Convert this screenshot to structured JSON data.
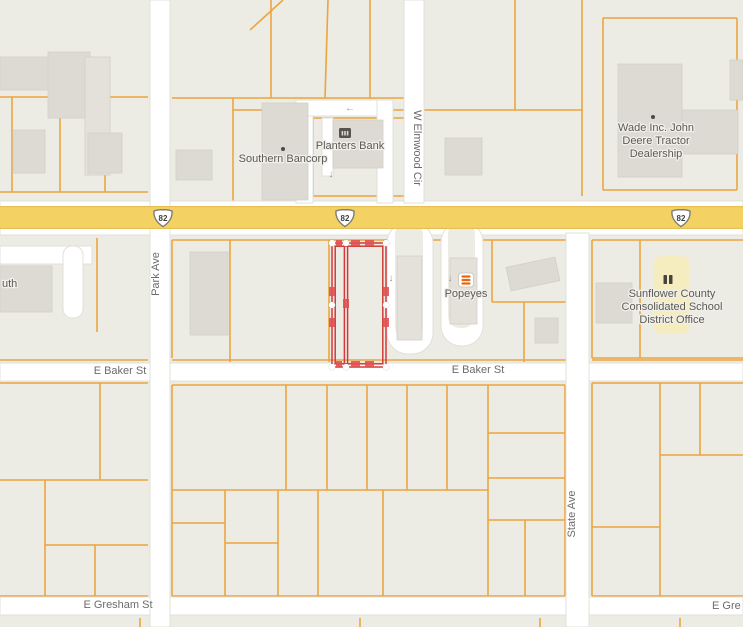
{
  "map": {
    "width": 743,
    "height": 627,
    "colors": {
      "background": "#ecebe4",
      "road": "#ffffff",
      "road_casing": "#e2e0d9",
      "parcel_line": "#eca53f",
      "building": "#dcdad2",
      "building_light": "#e3e1da",
      "building_border": "#d1cfc7",
      "highway": "#f3d263",
      "highway_edge": "#e6c055",
      "highlight_red": "#d43a3a",
      "highlight_tick": "#e05252",
      "school_area": "#f5edc0",
      "street_label": "#6b6b6b",
      "poi_label": "#5c5a54",
      "icon_dark": "#4b4a45",
      "popeyes_orange": "#e8680f",
      "arrow_gray": "#97958e"
    },
    "roads": [
      {
        "name": "us-82-road",
        "x": 0,
        "y": 201,
        "w": 743,
        "h": 34
      },
      {
        "name": "e-baker-st-road",
        "x": 0,
        "y": 363,
        "w": 743,
        "h": 18
      },
      {
        "name": "e-gresham-st-road",
        "x": 0,
        "y": 597,
        "w": 743,
        "h": 18
      },
      {
        "name": "park-ave-road",
        "x": 150,
        "y": 0,
        "w": 20,
        "h": 627
      },
      {
        "name": "w-elmwood-cir-road",
        "x": 404,
        "y": 0,
        "w": 20,
        "h": 203
      },
      {
        "name": "state-ave-road",
        "x": 566,
        "y": 233,
        "w": 23,
        "h": 394
      },
      {
        "name": "driveway",
        "x": 296,
        "y": 100,
        "w": 17,
        "h": 103
      },
      {
        "name": "driveway",
        "x": 296,
        "y": 100,
        "w": 97,
        "h": 16
      },
      {
        "name": "driveway",
        "x": 377,
        "y": 100,
        "w": 16,
        "h": 103
      },
      {
        "name": "driveway",
        "x": 322,
        "y": 118,
        "w": 11,
        "h": 58
      },
      {
        "name": "driveway-loop",
        "x": 387,
        "y": 222,
        "w": 46,
        "h": 132,
        "rx": 21
      },
      {
        "name": "driveway-loop",
        "x": 441,
        "y": 222,
        "w": 42,
        "h": 124,
        "rx": 20
      },
      {
        "name": "street-stub",
        "x": 0,
        "y": 246,
        "w": 92,
        "h": 18
      },
      {
        "name": "street-stub",
        "x": 63,
        "y": 246,
        "w": 20,
        "h": 72,
        "rx": 9
      }
    ],
    "road_islands": [
      {
        "x": 395,
        "y": 222,
        "w": 28,
        "h": 118,
        "rx": 13
      },
      {
        "x": 448,
        "y": 222,
        "w": 27,
        "h": 106,
        "rx": 12
      }
    ],
    "parcel_lines": [
      [
        0,
        97,
        148,
        97
      ],
      [
        12,
        97,
        12,
        192
      ],
      [
        60,
        97,
        60,
        192
      ],
      [
        105,
        97,
        105,
        192
      ],
      [
        0,
        192,
        148,
        192
      ],
      [
        172,
        98,
        404,
        98
      ],
      [
        233,
        98,
        233,
        201
      ],
      [
        271,
        0,
        271,
        98
      ],
      [
        250,
        30,
        283,
        0
      ],
      [
        328,
        0,
        325,
        98
      ],
      [
        370,
        0,
        370,
        98
      ],
      [
        233,
        110,
        404,
        110
      ],
      [
        313,
        110,
        313,
        196
      ],
      [
        313,
        118,
        404,
        118
      ],
      [
        313,
        196,
        404,
        196
      ],
      [
        582,
        0,
        582,
        196
      ],
      [
        424,
        110,
        582,
        110
      ],
      [
        515,
        0,
        515,
        110
      ],
      [
        603,
        18,
        737,
        18
      ],
      [
        603,
        18,
        603,
        190
      ],
      [
        737,
        18,
        737,
        190
      ],
      [
        603,
        190,
        737,
        190
      ],
      [
        592,
        240,
        743,
        240
      ],
      [
        592,
        240,
        592,
        358
      ],
      [
        640,
        240,
        640,
        358
      ],
      [
        592,
        358,
        743,
        358
      ],
      [
        172,
        240,
        566,
        240
      ],
      [
        172,
        240,
        172,
        358
      ],
      [
        230,
        240,
        230,
        362
      ],
      [
        329,
        240,
        329,
        362
      ],
      [
        430,
        240,
        430,
        292
      ],
      [
        492,
        240,
        492,
        302
      ],
      [
        492,
        302,
        566,
        302
      ],
      [
        524,
        302,
        524,
        362
      ],
      [
        0,
        360,
        148,
        360
      ],
      [
        172,
        360,
        566,
        360
      ],
      [
        592,
        360,
        743,
        360
      ],
      [
        97,
        238,
        97,
        332
      ],
      [
        0,
        383,
        148,
        383
      ],
      [
        100,
        383,
        100,
        480
      ],
      [
        0,
        480,
        148,
        480
      ],
      [
        45,
        480,
        45,
        597
      ],
      [
        45,
        545,
        148,
        545
      ],
      [
        95,
        545,
        95,
        597
      ],
      [
        0,
        596,
        148,
        596
      ],
      [
        172,
        385,
        565,
        385
      ],
      [
        172,
        385,
        172,
        596
      ],
      [
        565,
        385,
        565,
        596
      ],
      [
        172,
        596,
        565,
        596
      ],
      [
        172,
        490,
        488,
        490
      ],
      [
        286,
        385,
        286,
        490
      ],
      [
        327,
        385,
        327,
        490
      ],
      [
        367,
        385,
        367,
        490
      ],
      [
        407,
        385,
        407,
        490
      ],
      [
        447,
        385,
        447,
        490
      ],
      [
        488,
        385,
        488,
        596
      ],
      [
        488,
        433,
        565,
        433
      ],
      [
        488,
        478,
        565,
        478
      ],
      [
        488,
        520,
        565,
        520
      ],
      [
        525,
        520,
        525,
        596
      ],
      [
        172,
        523,
        225,
        523
      ],
      [
        225,
        490,
        225,
        596
      ],
      [
        225,
        543,
        278,
        543
      ],
      [
        278,
        490,
        278,
        596
      ],
      [
        318,
        490,
        318,
        596
      ],
      [
        383,
        490,
        383,
        596
      ],
      [
        592,
        383,
        743,
        383
      ],
      [
        592,
        383,
        592,
        596
      ],
      [
        660,
        383,
        660,
        596
      ],
      [
        660,
        455,
        743,
        455
      ],
      [
        592,
        527,
        660,
        527
      ],
      [
        700,
        383,
        700,
        455
      ],
      [
        592,
        596,
        743,
        596
      ],
      [
        140,
        618,
        140,
        627
      ],
      [
        360,
        618,
        360,
        627
      ],
      [
        540,
        618,
        540,
        627
      ],
      [
        680,
        618,
        680,
        627
      ]
    ],
    "buildings": [
      {
        "x": 0,
        "y": 57,
        "w": 88,
        "h": 33
      },
      {
        "x": 48,
        "y": 52,
        "w": 42,
        "h": 66
      },
      {
        "x": 85,
        "y": 57,
        "w": 25,
        "h": 118,
        "light": true
      },
      {
        "x": 13,
        "y": 130,
        "w": 32,
        "h": 43
      },
      {
        "x": 88,
        "y": 133,
        "w": 34,
        "h": 40
      },
      {
        "x": 176,
        "y": 150,
        "w": 36,
        "h": 30
      },
      {
        "x": 262,
        "y": 103,
        "w": 46,
        "h": 97
      },
      {
        "x": 333,
        "y": 120,
        "w": 50,
        "h": 48
      },
      {
        "x": 445,
        "y": 138,
        "w": 37,
        "h": 37
      },
      {
        "x": 618,
        "y": 64,
        "w": 64,
        "h": 113
      },
      {
        "x": 682,
        "y": 110,
        "w": 56,
        "h": 44
      },
      {
        "x": 730,
        "y": 60,
        "w": 13,
        "h": 40
      },
      {
        "x": 596,
        "y": 283,
        "w": 36,
        "h": 40
      },
      {
        "x": 190,
        "y": 252,
        "w": 38,
        "h": 83
      },
      {
        "x": 397,
        "y": 256,
        "w": 25,
        "h": 84,
        "light": true
      },
      {
        "x": 450,
        "y": 258,
        "w": 27,
        "h": 66,
        "light": true
      },
      {
        "x": 508,
        "y": 262,
        "w": 50,
        "h": 24,
        "rotate": -12
      },
      {
        "x": 535,
        "y": 318,
        "w": 23,
        "h": 25
      },
      {
        "x": 0,
        "y": 266,
        "w": 52,
        "h": 46
      }
    ],
    "school_area": {
      "x": 654,
      "y": 256,
      "w": 35,
      "h": 78
    },
    "highway": {
      "y": 206,
      "h": 23,
      "shield_label": "82",
      "shields": [
        {
          "x": 163,
          "y": 218
        },
        {
          "x": 345,
          "y": 218
        },
        {
          "x": 681,
          "y": 218
        }
      ]
    },
    "selected_parcel": {
      "x": 332,
      "y": 243,
      "w": 54,
      "h": 124,
      "divider_x": 346,
      "vertices": [
        [
          332,
          243
        ],
        [
          346,
          243
        ],
        [
          386,
          243
        ],
        [
          332,
          367
        ],
        [
          346,
          367
        ],
        [
          386,
          367
        ],
        [
          332,
          305
        ],
        [
          386,
          305
        ]
      ],
      "ticks": [
        [
          351,
          240,
          9,
          6
        ],
        [
          365,
          240,
          9,
          6
        ],
        [
          351,
          361,
          9,
          6
        ],
        [
          365,
          361,
          9,
          6
        ],
        [
          329,
          287,
          6,
          9
        ],
        [
          329,
          318,
          6,
          9
        ],
        [
          383,
          287,
          6,
          9
        ],
        [
          383,
          318,
          6,
          9
        ],
        [
          343,
          299,
          6,
          9
        ],
        [
          336,
          240,
          6,
          6
        ],
        [
          336,
          361,
          6,
          6
        ]
      ]
    },
    "arrows": [
      {
        "x": 331,
        "y": 177,
        "glyph": "↓"
      },
      {
        "x": 391,
        "y": 281,
        "glyph": "↓"
      },
      {
        "x": 450,
        "y": 281,
        "glyph": "↓"
      },
      {
        "x": 350,
        "y": 111,
        "glyph": "←"
      }
    ],
    "street_labels": [
      {
        "text": "Park Ave",
        "x": 159,
        "y": 274,
        "rotate": -90
      },
      {
        "text": "W Elmwood Cir",
        "x": 414,
        "y": 148,
        "rotate": 90
      },
      {
        "text": "State Ave",
        "x": 575,
        "y": 514,
        "rotate": -90
      },
      {
        "text": "E Baker St",
        "x": 120,
        "y": 374
      },
      {
        "text": "E Baker St",
        "x": 478,
        "y": 373
      },
      {
        "text": "E Gresham St",
        "x": 118,
        "y": 608
      },
      {
        "text": "E Gre",
        "x": 712,
        "y": 609,
        "anchor": "start"
      }
    ],
    "pois": [
      {
        "name": "southern-bancorp",
        "label_lines": [
          "Southern Bancorp"
        ],
        "x": 283,
        "y": 162,
        "dot": {
          "x": 283,
          "y": 149
        }
      },
      {
        "name": "planters-bank",
        "label_lines": [
          "Planters Bank"
        ],
        "x": 350,
        "y": 149,
        "icon": "bank-icon",
        "icon_x": 345,
        "icon_y": 133
      },
      {
        "name": "popeyes",
        "label_lines": [
          "Popeyes"
        ],
        "x": 466,
        "y": 297,
        "icon": "popeyes-icon",
        "icon_x": 466,
        "icon_y": 280
      },
      {
        "name": "wade-inc-john-deere",
        "label_lines": [
          "Wade Inc. John",
          "Deere Tractor",
          "Dealership"
        ],
        "x": 656,
        "y": 131,
        "dot": {
          "x": 653,
          "y": 117
        }
      },
      {
        "name": "school-district-office",
        "label_lines": [
          "Sunflower County",
          "Consolidated School",
          "District Office"
        ],
        "x": 672,
        "y": 297,
        "icon": "school-icon",
        "icon_x": 668,
        "icon_y": 280
      },
      {
        "name": "cut-off-poi",
        "label_lines": [
          "uth"
        ],
        "x": 2,
        "y": 287,
        "anchor": "start"
      }
    ]
  }
}
